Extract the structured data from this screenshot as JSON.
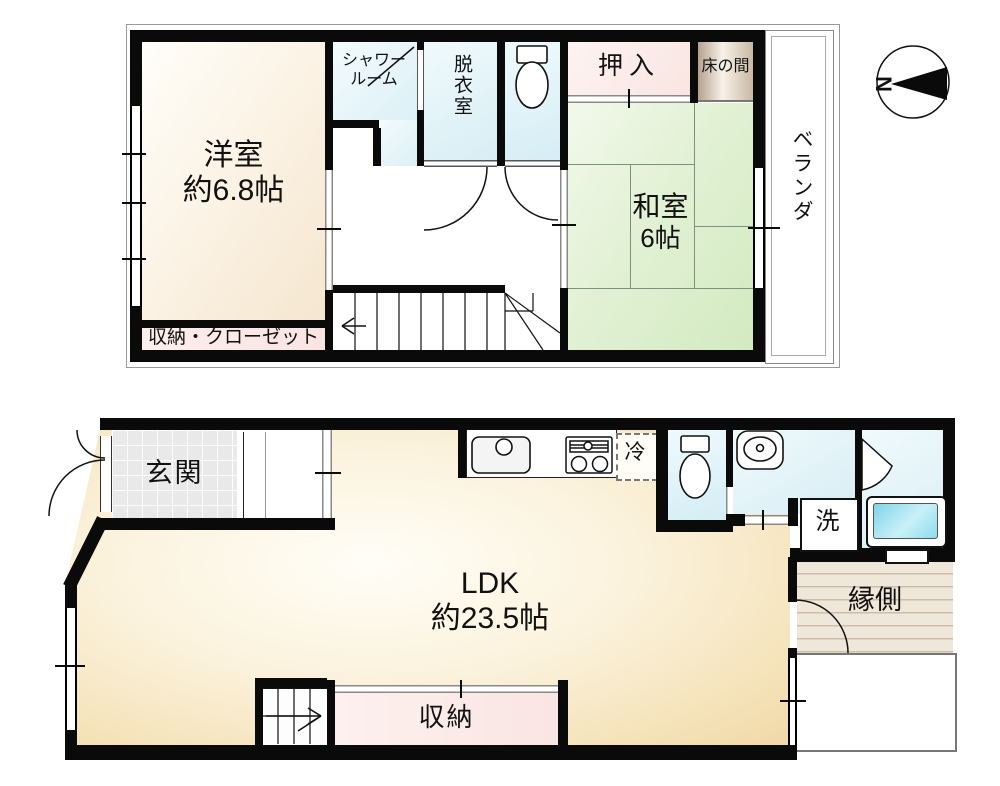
{
  "compass": {
    "north_label": "N"
  },
  "floor2": {
    "western_room": {
      "name": "洋室",
      "size": "約6.8帖"
    },
    "shower_room": {
      "line1": "シャワー",
      "line2": "ルーム"
    },
    "dressing_room": {
      "name": "脱衣室"
    },
    "oshiire": {
      "name": "押入"
    },
    "tokonoma": {
      "name": "床の間"
    },
    "japanese_room": {
      "name": "和室",
      "size": "6帖"
    },
    "veranda": {
      "name": "ベランダ"
    },
    "storage_closet": {
      "name": "収納・クローゼット"
    }
  },
  "floor1": {
    "entrance": {
      "name": "玄関"
    },
    "ldk": {
      "name": "LDK",
      "size": "約23.5帖"
    },
    "refrigerator": {
      "name": "冷"
    },
    "washing_machine": {
      "name": "洗"
    },
    "engawa": {
      "name": "縁側"
    },
    "storage": {
      "name": "収納"
    }
  },
  "icons": [
    "compass-icon",
    "toilet-icon",
    "kitchen-sink-icon",
    "stove-icon",
    "washbasin-icon",
    "bathtub-icon",
    "door-arc-icon",
    "stairs-up-arrow-icon",
    "stairs-down-arrow-icon"
  ],
  "colors": {
    "wall": "#0a0a0a",
    "western_room_fill": "#faf0e0",
    "japanese_room_fill": "#e2f1d4",
    "wet_room_fill": "#ddf1f7",
    "closet_fill": "#fbe9e7",
    "ldk_fill": "#f4e0b4",
    "wood_fill": "#d8c9b4",
    "bathtub_fill": "#8edcee"
  }
}
